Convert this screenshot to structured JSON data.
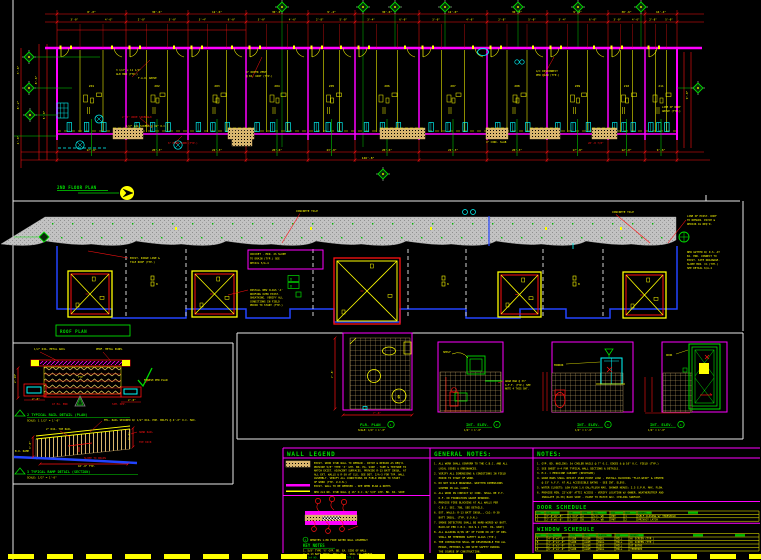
{
  "colors": {
    "background": "#000000",
    "dimension_red": "#ff1111",
    "text_yellow": "#ffff00",
    "wall_magenta": "#ff00ff",
    "centerline_green": "#00dd00",
    "fixture_cyan": "#00ffff",
    "hatch_tan": "#d8b56e",
    "roof_gray": "#c2c2c2",
    "outline_blue": "#2244ff",
    "viewport_white": "#e8e8e8"
  },
  "floor_plan": {
    "title": "2ND FLOOR PLAN",
    "wall_x": [
      57,
      126,
      188,
      246,
      308,
      355,
      419,
      487,
      547,
      608,
      645,
      677
    ],
    "room_labels": [
      "201",
      "202",
      "203",
      "204",
      "205",
      "206",
      "207",
      "208",
      "209",
      "210",
      "211"
    ],
    "dims_top": [
      "8'-0\"",
      "30'-6\"",
      "12'-6\"",
      "30'-0\"",
      "9'-4\"",
      "30'-6\"",
      "12'-0\"",
      "30'-0\"",
      "9'-4\"",
      "30'-6\"",
      "16'-4\""
    ],
    "dims_top2": [
      "3'-0\"",
      "4'-6\"",
      "2'-8\"",
      "5'-0\"",
      "3'-4\"",
      "6'-0\""
    ],
    "dims_bottom": [
      "17'-8\"",
      "20'-3\"",
      "22'-3\"",
      "20'-6\"",
      "23'-8\"",
      "20'-6\"",
      "22'-3\"",
      "20'-3\"",
      "17'-8\"",
      "12'-0\"",
      "9'-6\""
    ],
    "dim_overall": "146'-8\"",
    "dims_left": [
      {
        "t": "3'-6\"",
        "x": 19,
        "y": 70
      },
      {
        "t": "8'-2\"",
        "x": 19,
        "y": 105
      },
      {
        "t": "4'-0\"",
        "x": 19,
        "y": 140
      },
      {
        "t": "8'-6\"",
        "x": 37,
        "y": 80
      },
      {
        "t": "5'-0\"",
        "x": 45,
        "y": 115
      }
    ],
    "dims_right": [
      {
        "t": "9'-0\"",
        "x": 688,
        "y": 95
      }
    ],
    "grid_top_x": [
      282,
      363,
      395,
      445,
      518,
      578,
      641
    ],
    "grid_left": [
      [
        29,
        57
      ],
      [
        29,
        88
      ],
      [
        30,
        115
      ]
    ],
    "grid_right": [
      [
        698,
        88
      ]
    ],
    "grid_below": [
      [
        383,
        174
      ]
    ],
    "annotations": [
      {
        "t": "3 1/2\" x 11 1/4\"",
        "x": 116,
        "y": 71,
        "c": "y"
      },
      {
        "t": "GLB HDR (TYP.)",
        "x": 116,
        "y": 75,
        "c": "y"
      },
      {
        "t": "F.A.U. ABOVE",
        "x": 138,
        "y": 79,
        "c": "y"
      },
      {
        "t": "4\" DRYER VENT",
        "x": 246,
        "y": 73,
        "c": "y"
      },
      {
        "t": "@ EA. UNIT (TYP.)",
        "x": 246,
        "y": 77,
        "c": "y"
      },
      {
        "t": "A/C DISCONNECT",
        "x": 536,
        "y": 72,
        "c": "y"
      },
      {
        "t": "PER PLAN (TYP.)",
        "x": 536,
        "y": 76,
        "c": "y"
      },
      {
        "t": "2'-0\" WIDE SIDEWALK",
        "x": 122,
        "y": 118,
        "c": "r"
      },
      {
        "t": "1/2\" LAG SCREWS @ 32\" O.C.",
        "x": 126,
        "y": 127,
        "c": "y"
      },
      {
        "t": "6\" HIGH CURB (TYP.)",
        "x": 168,
        "y": 144,
        "c": "r"
      },
      {
        "t": "4\" CONC. SLAB",
        "x": 486,
        "y": 143,
        "c": "y"
      },
      {
        "t": "20'-8 7/8\"",
        "x": 588,
        "y": 144,
        "c": "r"
      },
      {
        "t": "LINE OF ROOF",
        "x": 662,
        "y": 108,
        "c": "y"
      },
      {
        "t": "ABOVE (TYP.)",
        "x": 662,
        "y": 112,
        "c": "y"
      }
    ],
    "leaders": [
      [
        132,
        77,
        150,
        60
      ],
      [
        252,
        78,
        262,
        57
      ],
      [
        543,
        77,
        554,
        57
      ],
      [
        140,
        118,
        152,
        128
      ],
      [
        175,
        143,
        182,
        136
      ]
    ],
    "patios": [
      [
        113,
        30
      ],
      [
        228,
        26
      ],
      [
        380,
        45
      ],
      [
        486,
        22
      ],
      [
        530,
        30
      ],
      [
        592,
        25
      ]
    ]
  },
  "roof_plan": {
    "title": "ROOF PLAN",
    "tile_label": "CONCRETE TILE",
    "tile_label_pos": [
      [
        296,
        212
      ],
      [
        612,
        213
      ]
    ],
    "crickets": [
      {
        "x": 68,
        "y": 271,
        "w": 44,
        "h": 46,
        "big": false
      },
      {
        "x": 192,
        "y": 271,
        "w": 45,
        "h": 46,
        "big": false
      },
      {
        "x": 334,
        "y": 258,
        "w": 66,
        "h": 66,
        "big": true
      },
      {
        "x": 498,
        "y": 272,
        "w": 43,
        "h": 45,
        "big": false
      },
      {
        "x": 623,
        "y": 272,
        "w": 43,
        "h": 46,
        "big": false
      }
    ],
    "note_box": {
      "x": 248,
      "y": 250,
      "w": 75,
      "h": 19,
      "lines": [
        "CRICKET - MIN. 2% SLOPE",
        "TO DRAIN (TYP.) SEE",
        "DETAIL 5/A-4"
      ]
    },
    "note_left": {
      "x": 130,
      "y": 259,
      "lines": [
        "EXIST. RIDGE LINE &",
        "TILE ROOF (TYP.)"
      ]
    },
    "note_mid": {
      "x": 250,
      "y": 291,
      "lines": [
        "INSTALL NEW CLASS 'A'",
        "ROOFING OVER EXIST.",
        "SHEATHING. VERIFY ALL",
        "CONDITIONS IN FIELD",
        "PRIOR TO START (TYP.)"
      ]
    },
    "note_right1": {
      "x": 687,
      "y": 217,
      "lines": [
        "LINE OF EXIST. ROOF",
        "TO REMAIN. PATCH &",
        "REPAIR AS REQ'D."
      ]
    },
    "note_right2": {
      "x": 687,
      "y": 253,
      "lines": [
        "NEW GUTTER W/ D.S. AT",
        "EA. END. CONNECT TO",
        "EXIST. SITE DRAINAGE.",
        "SLOPE MIN. 1% (TYP.)",
        "SEE DETAIL 6/A-4"
      ]
    },
    "d_markers": [
      "D",
      "D"
    ],
    "bay_glyph_x": [
      151,
      442,
      573
    ]
  },
  "detail_plan": {
    "title": "2  TYPICAL RAIL DETAIL (PLAN)",
    "scale": "SCALE: 1 1/2\" = 1'-0\"",
    "annotations": [
      {
        "t": "1/2\" DIA. METAL RAIL",
        "x": 34,
        "y": 350,
        "c": "y"
      },
      {
        "t": "PERF. METAL PANEL",
        "x": 96,
        "y": 350,
        "c": "y"
      },
      {
        "t": "FINISH PER PLAN",
        "x": 144,
        "y": 381,
        "c": "y"
      },
      {
        "t": "TYP",
        "x": 78,
        "y": 378,
        "c": "y"
      },
      {
        "t": "2'-0\"",
        "x": 32,
        "y": 400,
        "c": "y"
      },
      {
        "t": "2'-0\"",
        "x": 128,
        "y": 401,
        "c": "y"
      },
      {
        "t": "AT EA. END",
        "x": 52,
        "y": 405,
        "c": "r"
      },
      {
        "t": "SIM. OPP.",
        "x": 112,
        "y": 405,
        "c": "r"
      },
      {
        "t": "2'-10\"",
        "x": 16,
        "y": 383,
        "c": "y",
        "r": -90
      }
    ]
  },
  "detail_section": {
    "title": "3  TYPICAL RAMP DETAIL (SECTION)",
    "scale": "SCALE: 1/2\" = 1'-0\"",
    "annotations": [
      {
        "t": "MTL. RAIL SECURED W/ 1/2\" DIA. EXP. BOLTS @ 4'-0\" O.C. MAX.",
        "x": 104,
        "y": 421,
        "c": "y"
      },
      {
        "t": "2\" DIA. TOP RAIL",
        "x": 46,
        "y": 430,
        "c": "y"
      },
      {
        "t": "HAND RAIL",
        "x": 139,
        "y": 433,
        "c": "r"
      },
      {
        "t": "TOE KICK",
        "x": 139,
        "y": 443,
        "c": "r"
      },
      {
        "t": "B.O. RAMP",
        "x": 15,
        "y": 452,
        "c": "y"
      },
      {
        "t": "SLOPE TO DRAIN",
        "x": 84,
        "y": 459,
        "c": "r"
      },
      {
        "t": "16'-0\" TYP.",
        "x": 78,
        "y": 467,
        "c": "y"
      },
      {
        "t": "3'-0\"",
        "x": 31,
        "y": 449,
        "c": "y",
        "r": -90
      },
      {
        "t": "3'-6\"",
        "x": 130,
        "y": 440,
        "c": "y",
        "r": -90
      }
    ]
  },
  "bath_details": {
    "d1": {
      "title": "FLR. PLAN",
      "num": "1",
      "scale": "SCALE: 1/4\" = 1'-0\"",
      "dim_left": "7'-8\"",
      "dim_bottom": "7'-6\"",
      "shower_mark": "G"
    },
    "d2": {
      "title": "INT. ELEV.",
      "num": "2",
      "scale": "1/4\" = 1'-0\"",
      "leader": "SHELF",
      "notes": [
        "GRAB BAR @ 33\"",
        "A.F.F. (TYP.) SEE",
        "NOTE 4 THIS SHT."
      ]
    },
    "d3": {
      "title": "INT. ELEV.",
      "num": "3",
      "scale": "1/4\" = 1'-0\"",
      "leader": "MIRROR"
    },
    "d4": {
      "title": "INT. ELEV.",
      "num": "4",
      "scale": "1/4\" = 1'-0\"",
      "leader": "DOOR"
    }
  },
  "legend": {
    "wall_legend": {
      "title": "WALL LEGEND",
      "item1_lines": [
        "EXIST. WOOD STUD WALL TO REMAIN - PATCH & REPAIR AS REQ'D.",
        "PROVIDE 5/8\" TYPE 'X' GYP. BD. EA. SIDE - TAPE & TEXTURE TO",
        "MATCH EXIST. ADJACENT SURFACES. PROVIDE R-13 BATT INSUL. AT",
        "ALL EXT. WALLS & R-30 AT CLG. SEE DET. 2/A-3 FOR TYP. WALL",
        "ASSEMBLY. VERIFY ALL CONDITIONS IN FIELD PRIOR TO START",
        "OF WORK (TYP. U.O.N.)"
      ],
      "item2_text": "EXIST. WALL TO BE REMOVED - SEE DEMO PLAN & NOTES",
      "item3_text": "NEW 2x4 WD. STUD WALL @ 16\" O.C. W/ 5/8\" GYP. BD. EA. SIDE",
      "intro_num": "1",
      "intro_text": "DENOTES 1-HR FIRE RATED WALL ASSEMBLY",
      "key_notes_title": "KEY NOTES",
      "key_notes": [
        {
          "t": "1. 5/8\" TYPE 'X' GYP. BD. EA. SIDE OF WALL",
          "c": "y"
        },
        {
          "t": "2. R-13 BATT INSUL. FULL HT. - SEAL ALL PENETR.",
          "c": "y"
        },
        {
          "t": "3. 2x4 WD. STUDS @ 16\" O.C. (TYP.)",
          "c": "g"
        },
        {
          "t": "4. 1/2\" PLYWD. SHT'G. WHERE OCCURS",
          "c": "y"
        }
      ]
    },
    "general_notes": {
      "title": "GENERAL NOTES:",
      "lines": [
        "1. ALL WORK SHALL CONFORM TO THE C.B.C. AND ALL",
        "   LOCAL CODES & ORDINANCES.",
        "2. VERIFY ALL DIMENSIONS & CONDITIONS IN FIELD",
        "   PRIOR TO START OF WORK.",
        "3. DO NOT SCALE DRAWINGS. WRITTEN DIMENSIONS",
        "   GOVERN IN ALL CASES.",
        "4. ALL WOOD IN CONTACT W/ CONC. SHALL BE P.T.",
        "   D.F. OR FOUNDATION GRADE REDWOOD.",
        "5. PROVIDE FIRE BLOCKING AT ALL WALLS PER",
        "   C.B.C. SEC. 708, SEE DETAILS.",
        "6. EXT. WALLS: R-13 BATT INSUL., CLG: R-30",
        "   BATT INSUL. (TYP. U.O.N.)",
        "7. SMOKE DETECTORS SHALL BE HARD-WIRED W/ BATT.",
        "   BACK-UP PER C.B.C. 310.9.1 (TYP. EA. UNIT)",
        "8. ALL GLAZING W/IN 18\" OF FLOOR OR 24\" OF DRS.",
        "   SHALL BE TEMPERED SAFETY GLASS (TYP.)",
        "9. THE CONTRACTOR SHALL BE RESPONSIBLE FOR ALL",
        "   MEANS, METHODS & JOB SITE SAFETY DURING",
        "   THE COURSE OF CONSTRUCTION."
      ]
    },
    "notes": {
      "title": "NOTES:",
      "lines": [
        "1. GYP. BD. NAILING: 5d COOLER NAILS @ 7\" O.C. EDGES & @ 10\" O.C. FIELD (TYP.)",
        "2. SEE SHEET A-4 FOR TYPICAL WALL SECTIONS & DETAILS.",
        "3. M.C. = MEDICINE CABINET (RECESSED)",
        "4. GRAB BARS SHALL RESIST 250# POINT LOAD - INSTALL BLOCKING \"FLAT-WISE\" & CENTER",
        "   @ 33\" A.F.F. AT ALL ACCESSIBLE BATHS - SEE INT. ELEVS.",
        "5. WATER CLOSETS: LOW FLOW 1.6 GAL/FLUSH MAX. SHOWER HEADS: 2.5 G.P.M. MAX. FLOW.",
        "6. PROVIDE MIN. 22\"x30\" ATTIC ACCESS - VERIFY LOCATION W/ OWNER. WEATHERSTRIP AND",
        "   INSULATE (R-30) BACK SIDE - PAINT TO MATCH ADJ. CEILING SURFACE."
      ]
    },
    "door_schedule": {
      "title": "DOOR SCHEDULE",
      "headers": [
        "SYM",
        "SIZE",
        "THK",
        "TYPE",
        "MATL",
        "FIN",
        "HDWR",
        "REMARKS"
      ],
      "rows": [
        [
          "1",
          "3'-0\"x6'-8\"",
          "1 3/4\"",
          "A",
          "S.C. WD",
          "PNT",
          "1",
          "SELF-CLOSING W/ THRESHOLD"
        ],
        [
          "2",
          "2'-8\"x6'-8\"",
          "1 3/8\"",
          "B",
          "H.C. WD",
          "PNT",
          "2",
          "PRIVACY LATCH"
        ]
      ]
    },
    "window_schedule": {
      "title": "WINDOW SCHEDULE",
      "headers": [
        "SYM",
        "SIZE",
        "TYPE",
        "MATL",
        "GLAZING",
        "FIN",
        "REMARKS"
      ],
      "rows": [
        [
          "A",
          "4'-0\"x4'-0\"",
          "SLDR",
          "ALUM",
          "DUAL",
          "MILL",
          "W/ SCREEN (TYP.)"
        ],
        [
          "B",
          "3'-0\"x4'-0\"",
          "SLDR",
          "ALUM",
          "DUAL",
          "MILL",
          "W/ SCREEN (TYP.)"
        ],
        [
          "C",
          "2'-0\"x3'-0\"",
          "S.H.",
          "ALUM",
          "OBSC",
          "MILL",
          "AT BATHS"
        ],
        [
          "D",
          "6'-0\"x4'-0\"",
          "SLDR",
          "ALUM",
          "DUAL",
          "MILL",
          "TEMPERED"
        ]
      ]
    }
  }
}
